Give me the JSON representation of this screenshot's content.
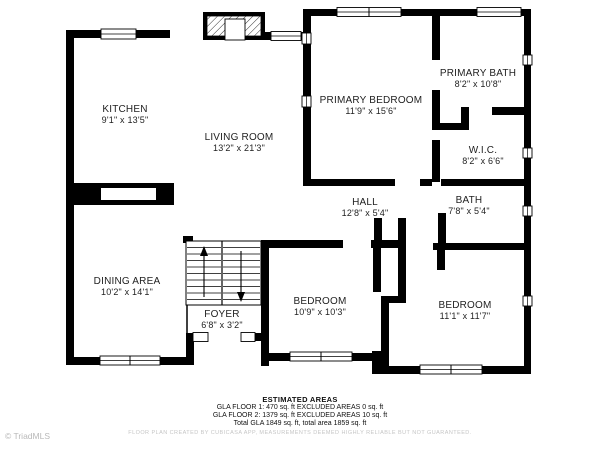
{
  "watermark": "© TriadMLS",
  "colors": {
    "wall": "#000000",
    "label_text": "#1f1f1f",
    "disclaimer_text": "#c6c6c6",
    "watermark_text": "#b9b9b9"
  },
  "rooms": [
    {
      "name": "KITCHEN",
      "dims": "9'1\" x 13'5\""
    },
    {
      "name": "LIVING ROOM",
      "dims": "13'2\" x 21'3\""
    },
    {
      "name": "PRIMARY BEDROOM",
      "dims": "11'9\" x 15'6\""
    },
    {
      "name": "PRIMARY BATH",
      "dims": "8'2\" x 10'8\""
    },
    {
      "name": "W.I.C.",
      "dims": "8'2\" x 6'6\""
    },
    {
      "name": "HALL",
      "dims": "12'8\" x 5'4\""
    },
    {
      "name": "BATH",
      "dims": "7'8\" x 5'4\""
    },
    {
      "name": "DINING AREA",
      "dims": "10'2\" x 14'1\""
    },
    {
      "name": "FOYER",
      "dims": "6'8\" x 3'2\""
    },
    {
      "name": "BEDROOM",
      "dims": "10'9\" x 10'3\""
    },
    {
      "name": "BEDROOM",
      "dims": "11'1\" x 11'7\""
    }
  ],
  "estimated_areas": {
    "title": "ESTIMATED AREAS",
    "lines": [
      "GLA FLOOR 1: 470 sq. ft EXCLUDED AREAS 0 sq. ft",
      "GLA FLOOR 2: 1379 sq. ft EXCLUDED AREAS 10 sq. ft",
      "Total GLA 1849 sq. ft, total area 1859 sq. ft"
    ]
  },
  "disclaimer": "FLOOR PLAN CREATED BY CUBICASA APP, MEASUREMENTS DEEMED HIGHLY RELIABLE BUT NOT GUARANTEED."
}
